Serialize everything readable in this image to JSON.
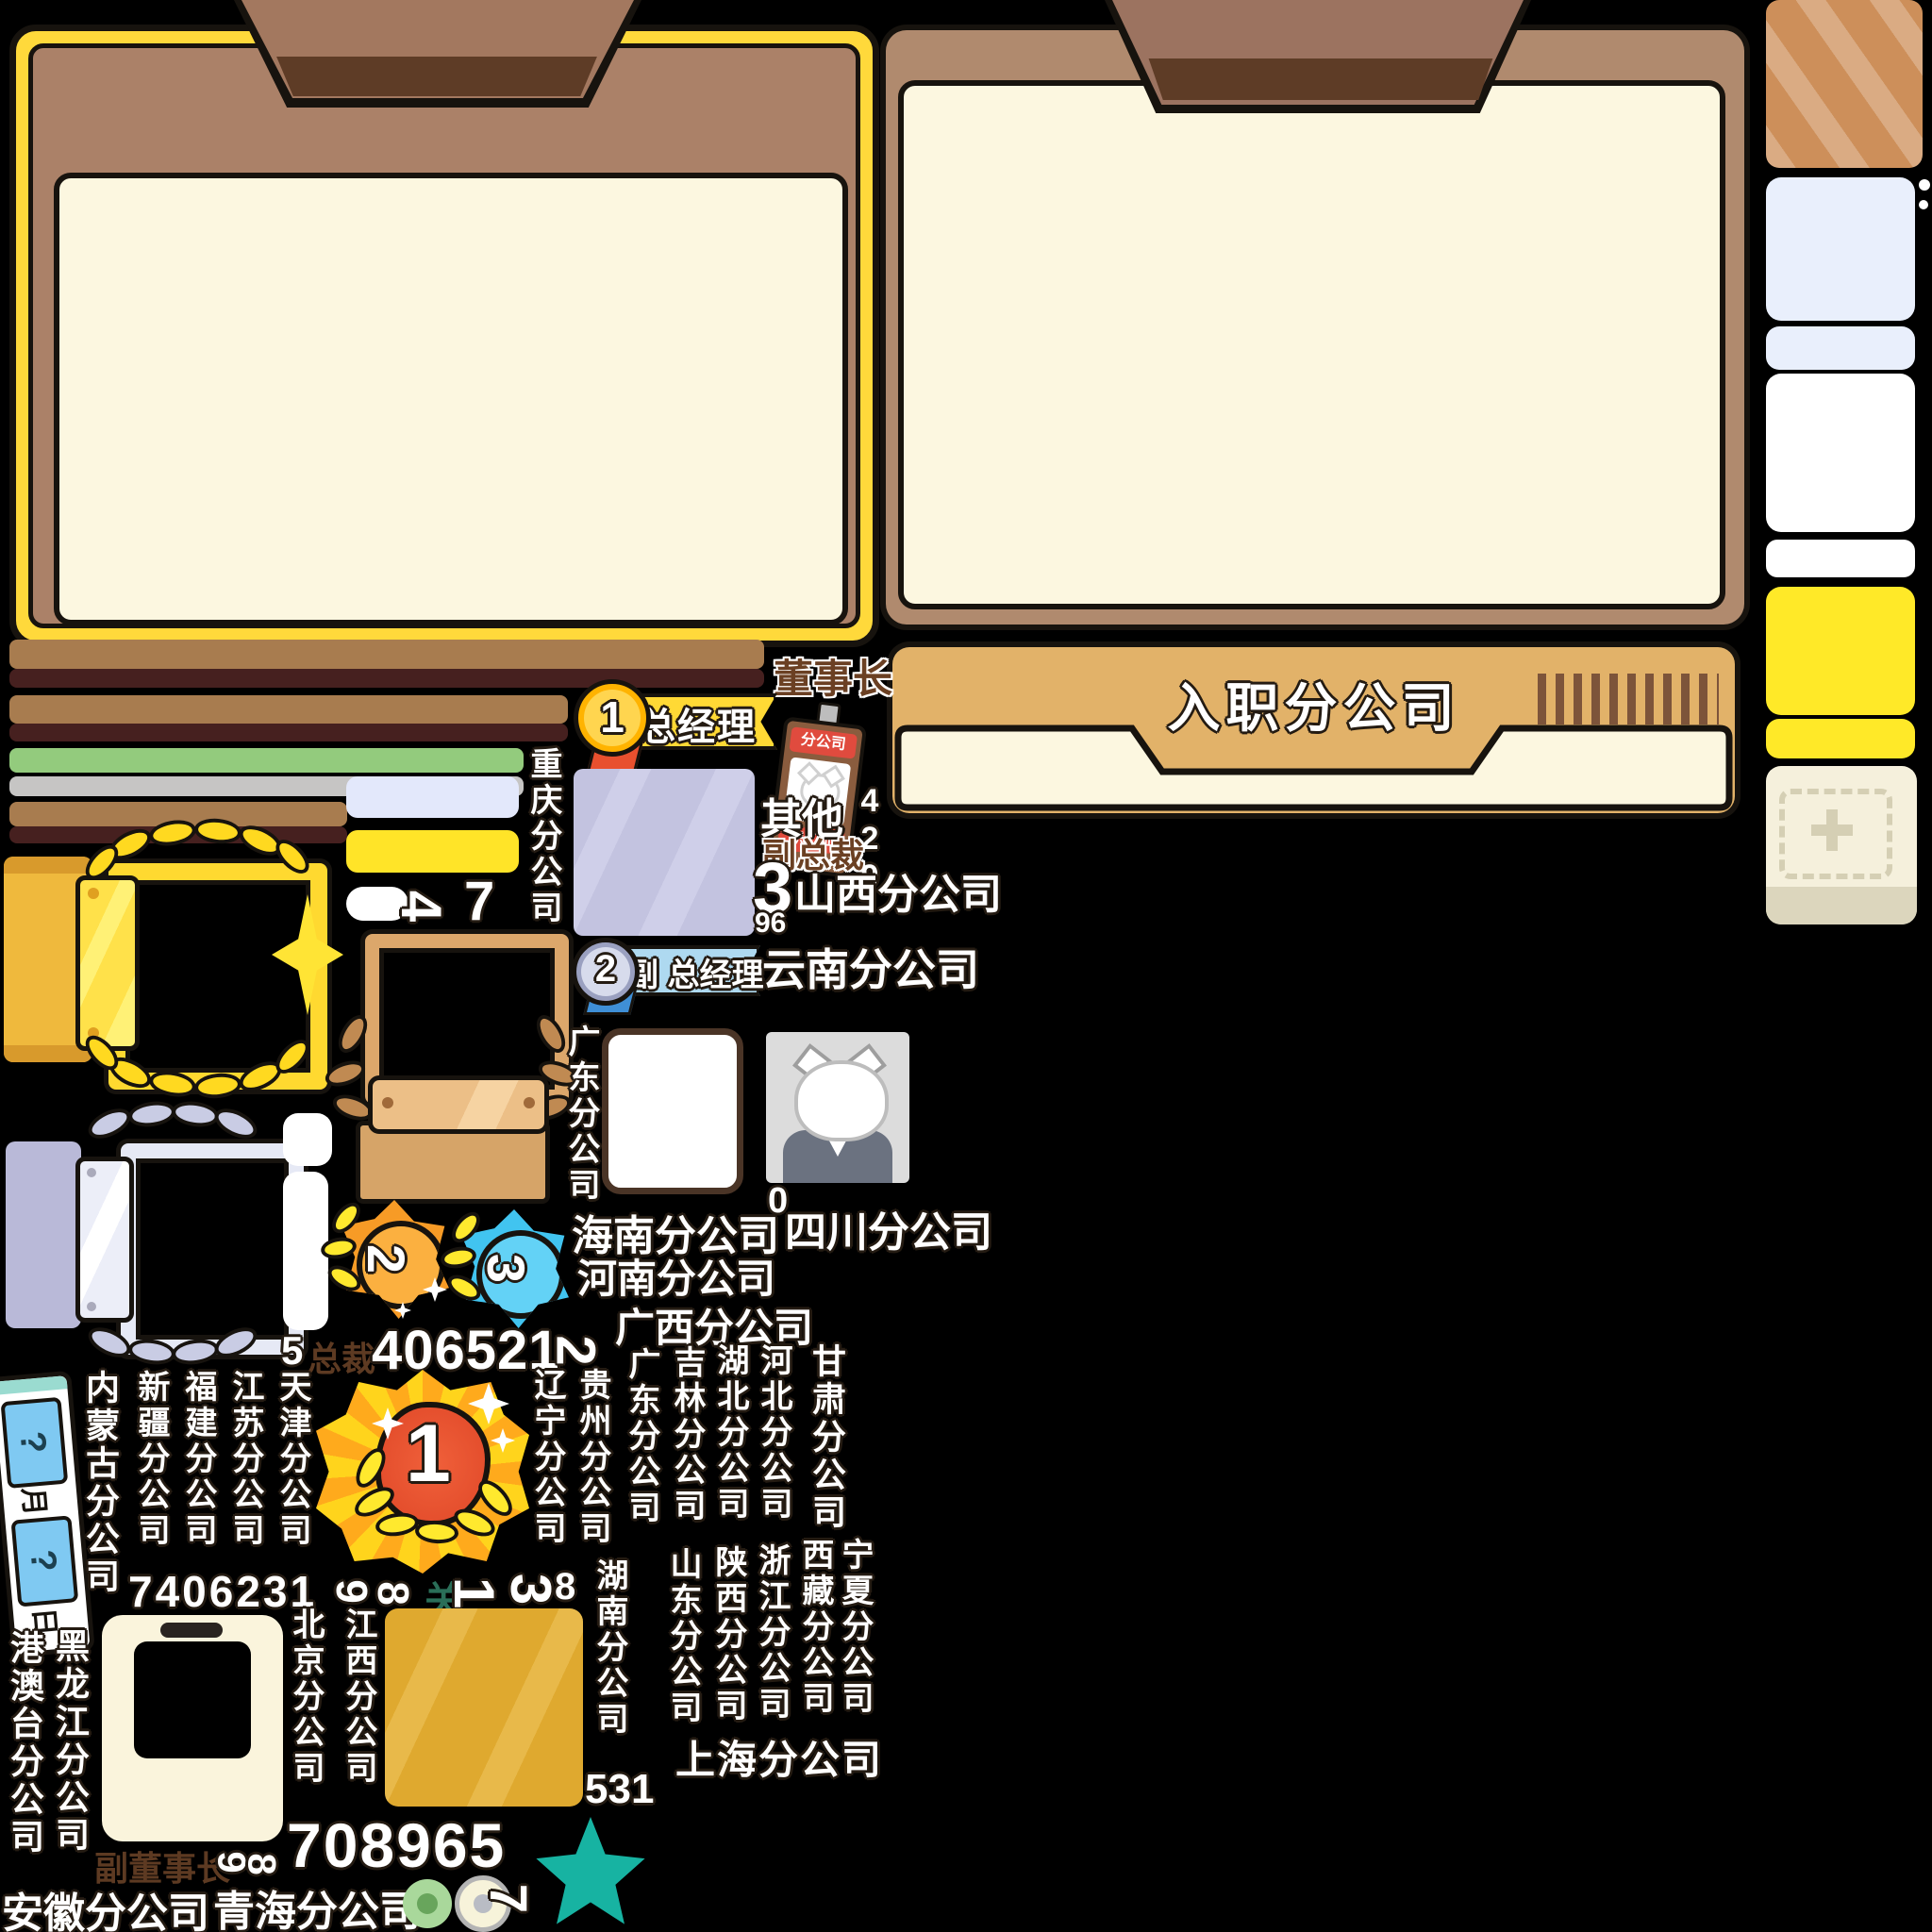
{
  "colors": {
    "panel_yellow": "#ffd93b",
    "panel_brown": "#ab8168",
    "panel_tan_border": "#b08a6e",
    "cream": "#fcf7e0",
    "tab_brown": "#a3785f",
    "tab_dark": "#5e3c26",
    "card_gold": "#e2b269",
    "bar_brown": "#a87c4f",
    "bar_maroon": "#46201f",
    "bar_green": "#93cb7d",
    "bar_gray": "#c6c5c4",
    "accent_yellow": "#ffe428",
    "teal_star": "#17b3a2",
    "medal_gold": "#ffd54f",
    "medal_silver": "#c9cde4",
    "star_orange": "#f79b26",
    "star_blue": "#41c4f0",
    "badge_red": "#e04b3e"
  },
  "header_card": {
    "title": "入职分公司"
  },
  "ranks": {
    "chairman": "董事长",
    "rank1_no": "1",
    "rank1_label": "总经理",
    "rank2_no": "2",
    "rank2_label": "副 总经理",
    "vice_president": "副总裁",
    "president": "总裁",
    "vice_chairman": "副董事长",
    "other": "其他"
  },
  "id_badge": {
    "top_label": "分公司",
    "bottom_label": "职工证"
  },
  "medals": {
    "star2": "2",
    "star3": "3",
    "big1": "1"
  },
  "gate_label": "关",
  "calendar": {
    "q1": "?",
    "month": "月",
    "q2": "?",
    "day": "日"
  },
  "numbers": {
    "n429": "429",
    "n3": "3",
    "n96": "96",
    "n4": "4",
    "n7": "7",
    "n0": "0",
    "n5": "5",
    "n406521": "406521",
    "n2": "2",
    "n7406231": "7406231",
    "n9": "9",
    "n8": "8",
    "n1": "1",
    "n3b": "3",
    "n8b": "8",
    "n531": "531",
    "n708965": "708965",
    "n9b": "9",
    "n8c": "8",
    "n7b": "7"
  },
  "branches": {
    "chongqing": "重庆分公司",
    "shanxi": "山西分公司",
    "yunnan": "云南分公司",
    "guangdong": "广东分公司",
    "hainan": "海南分公司",
    "sichuan": "四川分公司",
    "henan": "河南分公司",
    "guangxi": "广西分公司",
    "neimenggu": "内蒙古分公司",
    "xinjiang": "新疆分公司",
    "fujian": "福建分公司",
    "jiangsu": "江苏分公司",
    "tianjin": "天津分公司",
    "liaoning": "辽宁分公司",
    "guizhou": "贵州分公司",
    "guangdong2": "广东分公司",
    "jilin": "吉林分公司",
    "hubei": "湖北分公司",
    "hebei": "河北分公司",
    "gansu": "甘肃分公司",
    "ningxia": "宁夏分公司",
    "xizang": "西藏分公司",
    "zhejiang": "浙江分公司",
    "shaanxi": "陕西分公司",
    "shandong": "山东分公司",
    "hunan": "湖南分公司",
    "shanghai": "上海分公司",
    "beijing": "北京分公司",
    "jiangxi": "江西分公司",
    "heilongjiang": "黑龙江分公司",
    "gangaotai": "港澳台分公司",
    "anhui": "安徽分公司",
    "qinghai": "青海分公司"
  }
}
